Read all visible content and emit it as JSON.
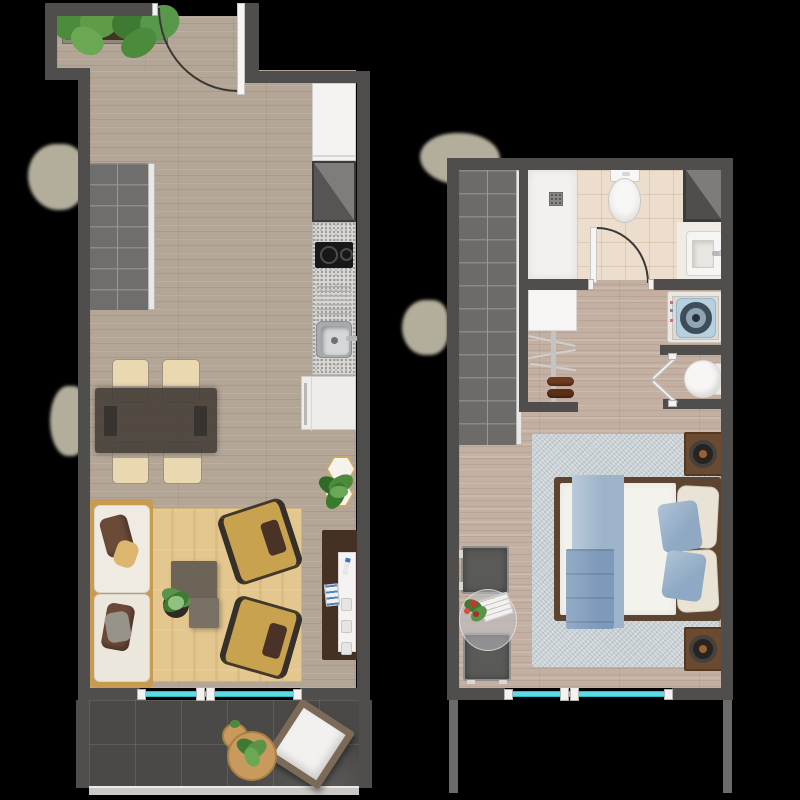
{
  "meta": {
    "type": "architectural floor plan, top-down 3D render",
    "canvas": {
      "width_px": 800,
      "height_px": 800,
      "background": "#000000"
    },
    "floors_shown": 2,
    "visible_text_labels": []
  },
  "palette": {
    "wall": "#4f4e4c",
    "wood_floor_lower": "#b4a696",
    "wood_floor_upper": "#c3b0a3",
    "stairs": "#706e6c",
    "balcony_tile": "#4b4947",
    "window_glass_teal": "#5cdbe6",
    "living_rug_tan": "#e4c78e",
    "bedroom_rug_blue_gray": "#c9d1d5",
    "sofa_cushion": "#f0ebe2",
    "sofa_frame_wood": "#c79b52",
    "armchair_mustard": "#c9a24f",
    "coffee_table_taupe": "#6d6458",
    "dining_chair_cream": "#ead8b0",
    "bed_frame_wood": "#5d4430",
    "bed_duvet": "#f4f2ed",
    "bed_throw_blue": "#9cb3ca",
    "bathroom_tile_beige": "#ecddcd",
    "shrub_beige": "#b3ae9c",
    "washer_lid_blue": "#b7d0e0"
  },
  "lower_floor": {
    "name": "lower floor plan (living level)",
    "rooms": [
      "entry",
      "staircase",
      "kitchen",
      "dining area",
      "living room",
      "balcony"
    ],
    "furniture": [
      "entry door with swing arc",
      "planter box with plants",
      "staircase with handrail",
      "kitchen tall cabinet",
      "corner cabinet",
      "two-burner cooktop",
      "drainboard",
      "kitchen sink with faucet",
      "refrigerator",
      "glass dining table",
      "dining chair x4",
      "table runner x2",
      "three-seat sofa with pillows",
      "tan area rug",
      "mustard armchair x2",
      "coffee table x2",
      "potted plant",
      "hexagonal side table x2",
      "tv sideboard",
      "television",
      "magazines",
      "sliding window",
      "balcony round table x2",
      "balcony potted plant",
      "balcony lounge chair",
      "glass balcony railing"
    ]
  },
  "upper_floor": {
    "name": "upper floor plan (bedroom level)",
    "rooms": [
      "staircase",
      "bathroom",
      "hall closet",
      "laundry niche",
      "bedroom",
      "void over balcony"
    ],
    "furniture": [
      "staircase with handrail",
      "walk-in shower with drain",
      "toilet",
      "corner wardrobe",
      "wash basin with faucet",
      "bathroom door with swing arc",
      "closet panel",
      "coat rack with shoes",
      "top-load washing machine",
      "bifold door",
      "round seat in niche",
      "double bed with duvet",
      "blue bed runner",
      "folded blanket",
      "pillow x4",
      "nightstand with lamp x2",
      "blue-gray bedroom rug",
      "gray chair x2",
      "round glass side table with flowers and magazine",
      "sliding window"
    ]
  }
}
